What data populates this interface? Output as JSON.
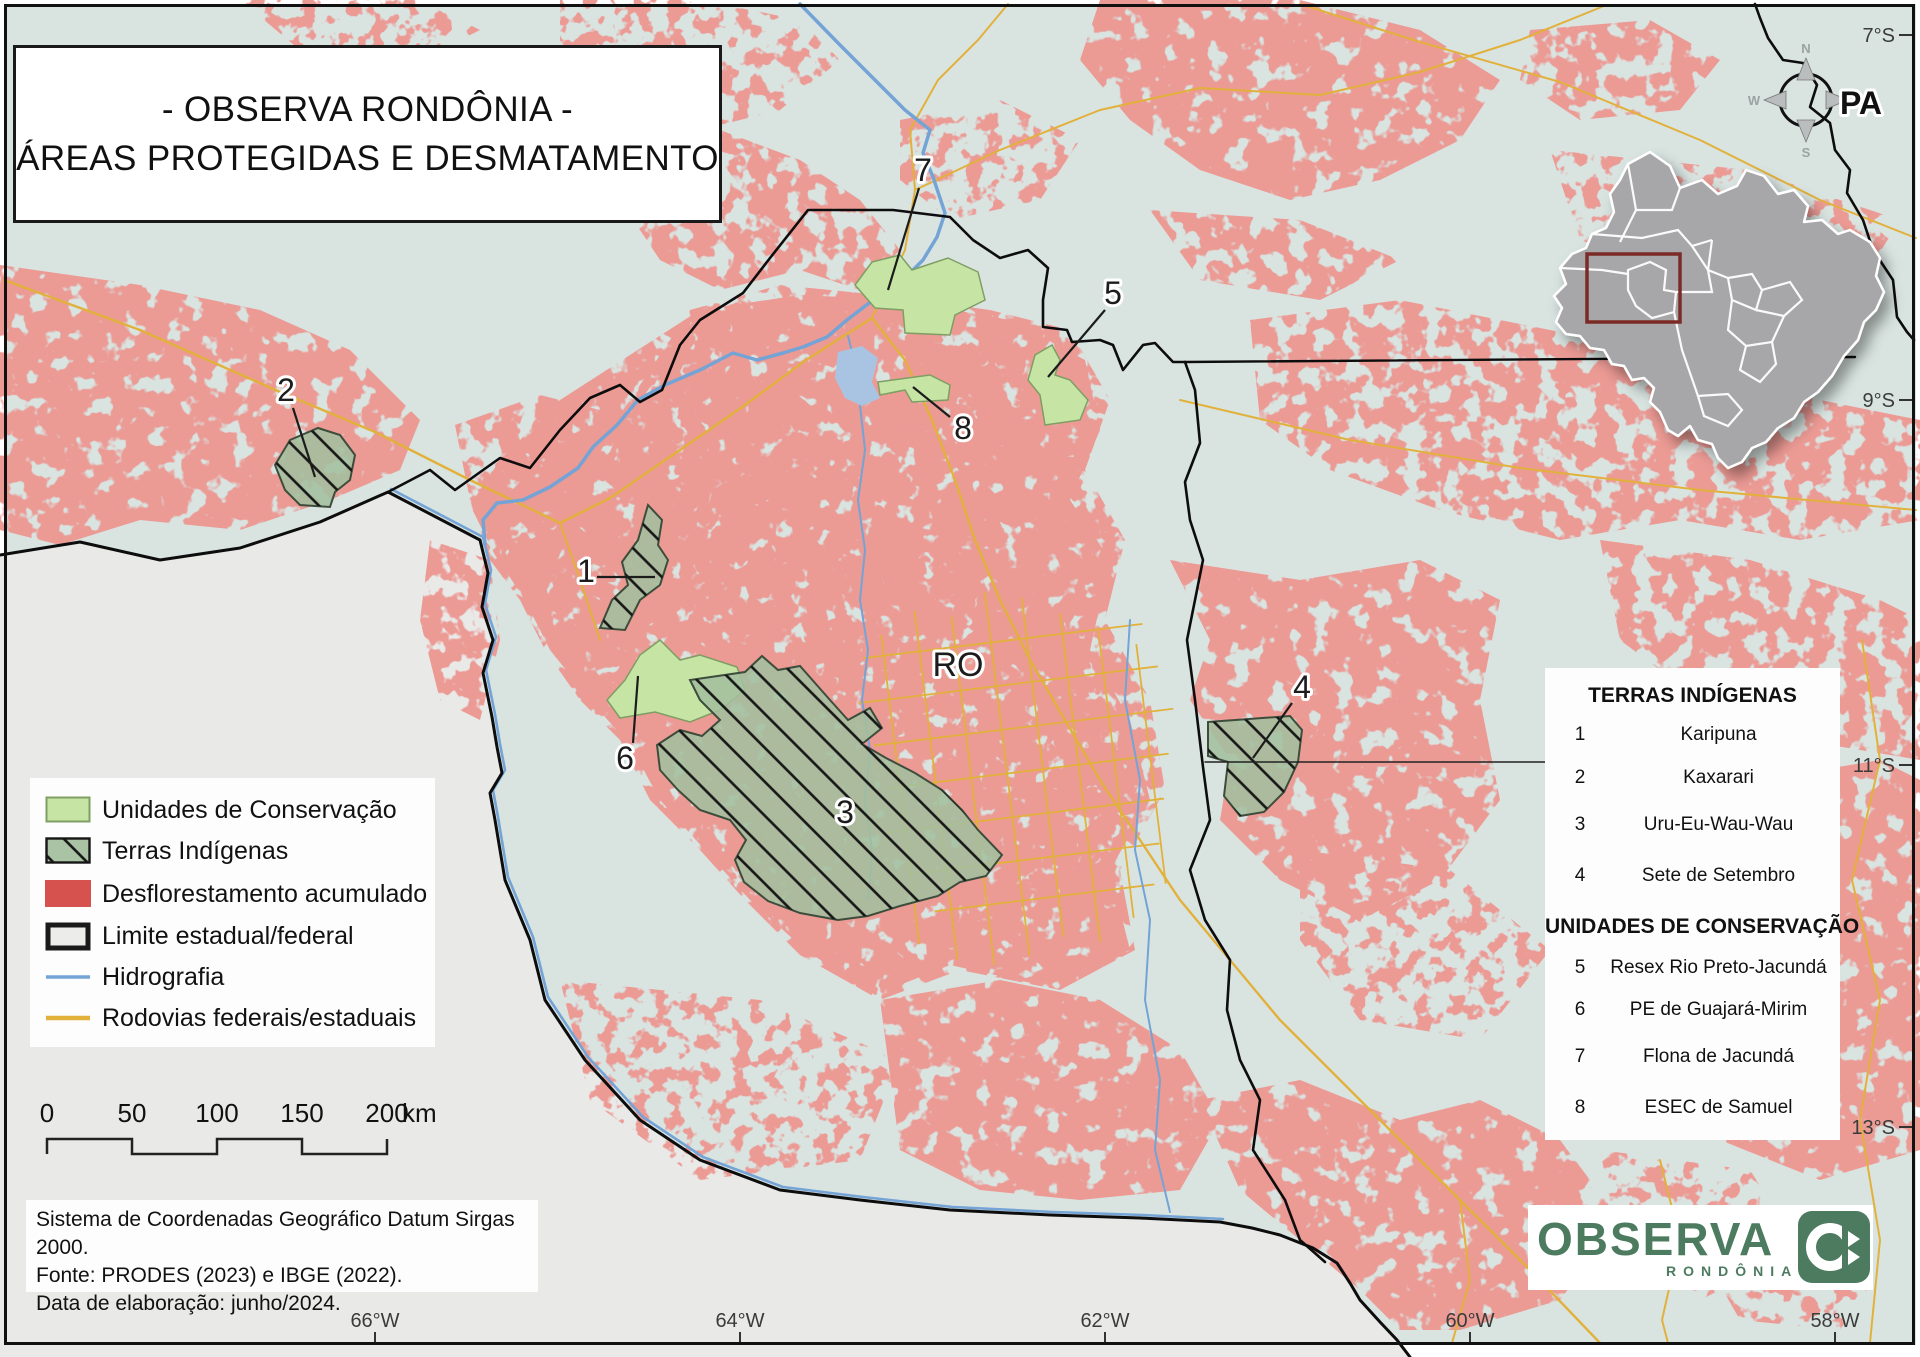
{
  "title": {
    "line1": "- OBSERVA RONDÔNIA -",
    "line2": "ÁREAS PROTEGIDAS E DESMATAMENTO"
  },
  "legend": {
    "items": [
      {
        "id": "uc",
        "label": "Unidades de Conservação",
        "swatch": "green-fill"
      },
      {
        "id": "ti",
        "label": "Terras Indígenas",
        "swatch": "green-hatch"
      },
      {
        "id": "defor",
        "label": "Desflorestamento acumulado",
        "swatch": "red-fill"
      },
      {
        "id": "limite",
        "label": "Limite estadual/federal",
        "swatch": "black-outline"
      },
      {
        "id": "hidro",
        "label": "Hidrografia",
        "swatch": "blue-line"
      },
      {
        "id": "rodovias",
        "label": "Rodovias federais/estaduais",
        "swatch": "yellow-line"
      }
    ]
  },
  "scalebar": {
    "ticks": [
      "0",
      "50",
      "100",
      "150",
      "200"
    ],
    "unit": "km"
  },
  "source_note": {
    "line1": "Sistema de Coordenadas Geográfico Datum Sirgas 2000.",
    "line2": "Fonte: PRODES (2023) e IBGE (2022).",
    "line3": "Data de elaboração: junho/2024."
  },
  "side_panel": {
    "terras_title": "TERRAS INDÍGENAS",
    "terras": [
      {
        "num": "1",
        "name": "Karipuna"
      },
      {
        "num": "2",
        "name": "Kaxarari"
      },
      {
        "num": "3",
        "name": "Uru-Eu-Wau-Wau"
      },
      {
        "num": "4",
        "name": "Sete de Setembro"
      }
    ],
    "unidades_title": "UNIDADES DE CONSERVAÇÃO",
    "unidades": [
      {
        "num": "5",
        "name": "Resex Rio Preto-Jacundá"
      },
      {
        "num": "6",
        "name": "PE de Guajará-Mirim"
      },
      {
        "num": "7",
        "name": "Flona de Jacundá"
      },
      {
        "num": "8",
        "name": "ESEC de Samuel"
      }
    ]
  },
  "map_labels": {
    "state": "RO",
    "neighbor_state": "PA",
    "area_numbers": [
      "1",
      "2",
      "3",
      "4",
      "5",
      "6",
      "7",
      "8"
    ]
  },
  "compass": {
    "n": "N",
    "e": "E",
    "s": "S",
    "w": "W"
  },
  "graticule": {
    "latitudes": [
      "7°S",
      "9°S",
      "11°S",
      "13°S"
    ],
    "longitudes": [
      "66°W",
      "64°W",
      "62°W",
      "60°W",
      "58°W"
    ]
  },
  "logo": {
    "brand": "OBSERVA",
    "brand_sub": "RONDÔNIA"
  },
  "colors": {
    "deforestation": "#d5524e",
    "conservation_units": "#c6e5a5",
    "indigenous_lands": "#a3bf9e",
    "hydrography": "#74a3d6",
    "roads": "#e2b13c",
    "boundary": "#111111",
    "map_background": "#d9e4e1",
    "no_data_background": "#e9e9e7",
    "logo_green": "#4d7b60",
    "inset_highlight": "#7c2a26"
  }
}
